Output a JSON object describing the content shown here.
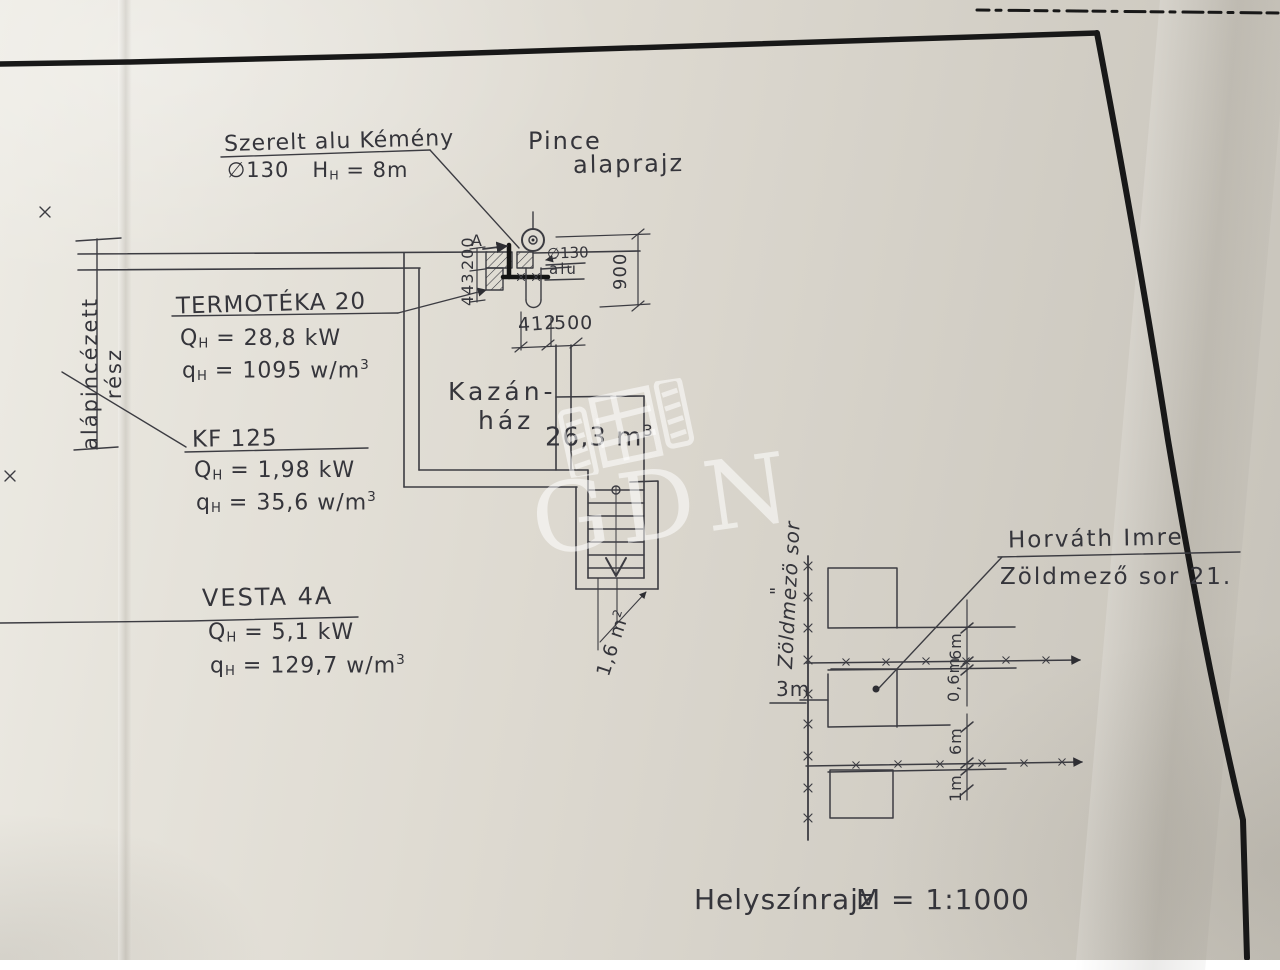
{
  "scan": {
    "watermark": "GDN",
    "footer": {
      "title": "Helyszínrajz",
      "scale": "M = 1:1000"
    }
  },
  "chimney_note": {
    "line1": "Szerelt alu Kémény",
    "diameter": "∅130",
    "h_base": "H",
    "h_sub": "H",
    "h_value": "= 8m"
  },
  "plan_title": {
    "line1": "Pince",
    "line2": "alaprajz"
  },
  "boilers": [
    {
      "name": "TERMOTÉKA 20",
      "q_base": "Q",
      "q_sub": "H",
      "q_rest": "= 28,8 kW",
      "s_base": "q",
      "s_sub": "H",
      "s_rest": "= 1095 w/m",
      "s_sup": "3"
    },
    {
      "name": "KF 125",
      "q_base": "Q",
      "q_sub": "H",
      "q_rest": "= 1,98 kW",
      "s_base": "q",
      "s_sub": "H",
      "s_rest": "= 35,6 w/m",
      "s_sup": "3"
    },
    {
      "name": "VESTA 4A",
      "q_base": "Q",
      "q_sub": "H",
      "q_rest": "= 5,1 kW",
      "s_base": "q",
      "s_sub": "H",
      "s_rest": "= 129,7 w/m",
      "s_sup": "3"
    }
  ],
  "room": {
    "name_line1": "Kazán-",
    "name_line2": "ház",
    "volume_base": "26,3 m",
    "volume_sup": "3"
  },
  "stair": {
    "area_base": "1,6 m",
    "area_sup": "2"
  },
  "section_label": "A",
  "dims": {
    "w200": "200",
    "w443": "443",
    "h900": "900",
    "w412": "412",
    "w500": "500",
    "flue": "∅130",
    "flue_mat": "alu"
  },
  "left_note": {
    "line1": "alápincézett",
    "line2": "rész"
  },
  "owner": {
    "line1": "Horváth Imre",
    "line2": "Zöldmező sor 21."
  },
  "site": {
    "street": "Zöldmezö sor",
    "ditto": "\"",
    "offset": "3m",
    "dim_top": "6m",
    "dim_gap": "0,6m",
    "dim_mid": "6m",
    "dim_bottom": "1m"
  }
}
